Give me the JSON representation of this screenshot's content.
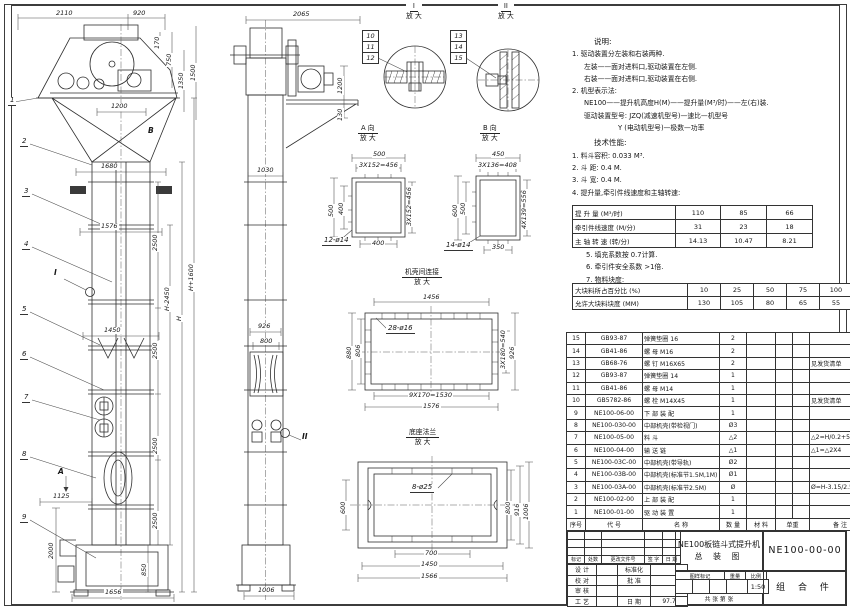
{
  "views": {
    "front": {
      "dims": [
        "2110",
        "920",
        "170",
        "750",
        "1350",
        "1500",
        "1200",
        "1680",
        "2500",
        "1576",
        "H-2450",
        "H",
        "H+1600",
        "1450",
        "2500",
        "2500",
        "2500",
        "1125",
        "2000",
        "850",
        "1656"
      ],
      "callouts": [
        "1",
        "2",
        "3",
        "4",
        "5",
        "6",
        "7",
        "8",
        "9"
      ],
      "markers": {
        "a": "A",
        "b": "B",
        "i": "I"
      }
    },
    "side": {
      "dims": [
        "2065",
        "1200",
        "130",
        "1030",
        "926",
        "800",
        "1006"
      ],
      "marker_ii": "II"
    },
    "detail_a": {
      "name": "A 向",
      "zoom": "放 大",
      "dims": [
        "500",
        "3X152=456",
        "500",
        "400",
        "3X152=456",
        "400"
      ],
      "holes": "12-ø14"
    },
    "detail_b": {
      "name": "B 向",
      "zoom": "放 大",
      "dims": [
        "450",
        "3X136=408",
        "600",
        "500",
        "4X139=556",
        "350"
      ],
      "holes": "14-ø14"
    },
    "section_i": {
      "name": "I",
      "zoom": "放 大",
      "callouts": [
        "10",
        "11",
        "12"
      ]
    },
    "section_ii": {
      "name": "II",
      "zoom": "放 大",
      "callouts": [
        "13",
        "14",
        "15"
      ]
    },
    "flange": {
      "name": "机壳间连接",
      "zoom": "放 大",
      "dims": [
        "1456",
        "880",
        "806",
        "3X180=540",
        "926",
        "9X170=1530",
        "1576"
      ],
      "holes": "28-ø16"
    },
    "base": {
      "name": "底座法兰",
      "zoom": "放 大",
      "dims": [
        "600",
        "800",
        "916",
        "1006",
        "700",
        "1450",
        "1566"
      ],
      "holes": "8-ø25"
    }
  },
  "notes": {
    "heading": "说明:",
    "lines": [
      "1. 驱动装置分左装和右装两种.",
      "左装——面对进料口,驱动装置在左侧.",
      "右装——面对进料口,驱动装置在右侧.",
      "2. 机型表示法:",
      "NE100——提升机高度H(M)——提升量(M³/时)——左(右)装.",
      "驱动装置型号: JZQ(减速机型号)—速比—机型号",
      "Y (电动机型号)—极数—功率"
    ]
  },
  "performance": {
    "heading": "技术性能:",
    "items": [
      "1. 料斗容积: 0.033 M³.",
      "2. 斗  距: 0.4 M.",
      "3. 斗  宽: 0.4 M.",
      "4. 提升量,牵引件线速度和主轴转速:"
    ],
    "table": {
      "rows": [
        {
          "label": "提 升 量  (M³/时)",
          "values": [
            "110",
            "85",
            "66"
          ]
        },
        {
          "label": "牵引件线速度 (M/分)",
          "values": [
            "31",
            "23",
            "18"
          ]
        },
        {
          "label": "主 轴 转 速  (转/分)",
          "values": [
            "14.13",
            "10.47",
            "8.21"
          ]
        }
      ]
    },
    "items2": [
      "5. 填充系数按 0.7计算.",
      "6. 牵引件安全系数 >1倍.",
      "7. 物料块度:"
    ],
    "lump_table": {
      "rows": [
        {
          "label": "大块料所占百分比 (%)",
          "values": [
            "10",
            "25",
            "50",
            "75",
            "100"
          ]
        },
        {
          "label": "允许大块料块度 (MM)",
          "values": [
            "130",
            "105",
            "80",
            "65",
            "55"
          ]
        }
      ]
    }
  },
  "bom": {
    "headers": [
      "序号",
      "代  号",
      "名    称",
      "数 量",
      "材  料",
      "单重",
      "总重",
      "备  注"
    ],
    "rows": [
      {
        "no": "15",
        "code": "GB93-87",
        "name": "弹簧垫圈  16",
        "qty": "2",
        "material": "",
        "remark": ""
      },
      {
        "no": "14",
        "code": "GB41-86",
        "name": "螺  母  M16",
        "qty": "2",
        "material": "",
        "remark": ""
      },
      {
        "no": "13",
        "code": "GB68-76",
        "name": "螺  钉  M16X65",
        "qty": "2",
        "material": "",
        "remark": "见发货清单"
      },
      {
        "no": "12",
        "code": "GB93-87",
        "name": "弹簧垫圈  14",
        "qty": "1",
        "material": "",
        "remark": ""
      },
      {
        "no": "11",
        "code": "GB41-86",
        "name": "螺  母  M14",
        "qty": "1",
        "material": "",
        "remark": ""
      },
      {
        "no": "10",
        "code": "GB5782-86",
        "name": "螺  栓  M14X45",
        "qty": "1",
        "material": "",
        "remark": "见发货清单"
      },
      {
        "no": "9",
        "code": "NE100-06-00",
        "name": "下 部 装 配",
        "qty": "1",
        "material": "",
        "remark": ""
      },
      {
        "no": "8",
        "code": "NE100-030-00",
        "name": "中部机壳(带检视门)",
        "qty": "Ø3",
        "material": "",
        "remark": ""
      },
      {
        "no": "7",
        "code": "NE100-05-00",
        "name": "料  斗",
        "qty": "△2",
        "material": "",
        "remark": "△2=H/0.2+5.75"
      },
      {
        "no": "6",
        "code": "NE100-04-00",
        "name": "输 送 链",
        "qty": "△1",
        "material": "",
        "remark": "△1=△2X4"
      },
      {
        "no": "5",
        "code": "NE100-03C-00",
        "name": "中部机壳(带导轨)",
        "qty": "Ø2",
        "material": "",
        "remark": ""
      },
      {
        "no": "4",
        "code": "NE100-03B-00",
        "name": "中部机壳(标准节1.5M,1M)",
        "qty": "Ø1",
        "material": "",
        "remark": ""
      },
      {
        "no": "3",
        "code": "NE100-03A-00",
        "name": "中部机壳(标准节2.5M)",
        "qty": "Ø",
        "material": "",
        "remark": "Ø=H-3.15/2.5"
      },
      {
        "no": "2",
        "code": "NE100-02-00",
        "name": "上 部 装 配",
        "qty": "1",
        "material": "",
        "remark": ""
      },
      {
        "no": "1",
        "code": "NE100-01-00",
        "name": "驱 动 装 置",
        "qty": "1",
        "material": "",
        "remark": ""
      }
    ]
  },
  "title_block": {
    "revision_headers": [
      "标记",
      "处数",
      "更改文件号",
      "签 字",
      "日 期"
    ],
    "sign_rows": [
      {
        "left": "设 计",
        "right": "标准化",
        "value": ""
      },
      {
        "left": "校 对",
        "right": "批 准",
        "value": ""
      },
      {
        "left": "审 核",
        "right": "",
        "value": ""
      },
      {
        "left": "工 艺",
        "right": "日 期",
        "value": "97.7"
      }
    ],
    "title_line1": "NE100板链斗式提升机",
    "title_line2": "总  装  图",
    "stamp_headers": [
      "图样标记",
      "重量",
      "比例"
    ],
    "scale": "1:50",
    "sheet_info": "共   张   第   张",
    "drawing_no": "NE100-00-00",
    "part_type": "组 合 件"
  }
}
